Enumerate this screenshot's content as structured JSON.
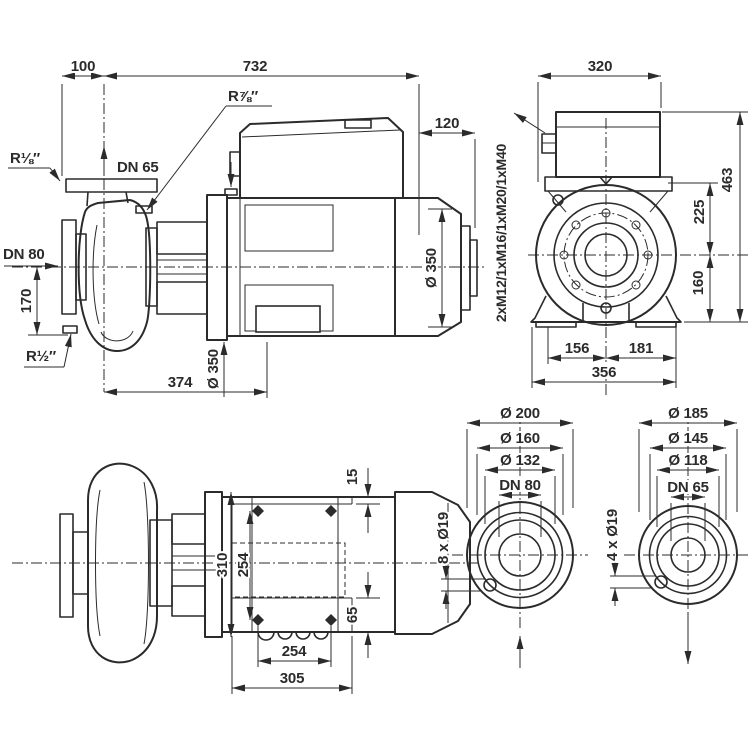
{
  "side": {
    "d100": "100",
    "d732": "732",
    "d120": "120",
    "r78": "R⅞″",
    "r18": "R⅛″",
    "dn65": "DN 65",
    "dn80": "DN 80",
    "d170": "170",
    "r12": "R½″",
    "d374": "374",
    "dia350_flange": "Ø 350",
    "dia350_motor": "Ø 350"
  },
  "front": {
    "d320": "320",
    "d463": "463",
    "d225": "225",
    "d160": "160",
    "d156": "156",
    "d181": "181",
    "d356": "356",
    "glands": "2xM12/1xM16/1xM20/1xM40"
  },
  "top": {
    "d15": "15",
    "d310": "310",
    "d254v": "254",
    "d65": "65",
    "d254": "254",
    "d305": "305"
  },
  "flange_dn80": {
    "d200": "Ø 200",
    "d160": "Ø 160",
    "d132": "Ø 132",
    "dn": "DN 80",
    "holes": "8 x Ø19"
  },
  "flange_dn65": {
    "d185": "Ø 185",
    "d145": "Ø 145",
    "d118": "Ø 118",
    "dn": "DN 65",
    "holes": "4 x Ø19"
  },
  "colors": {
    "line": "#2b2b2b",
    "bg": "#ffffff"
  }
}
